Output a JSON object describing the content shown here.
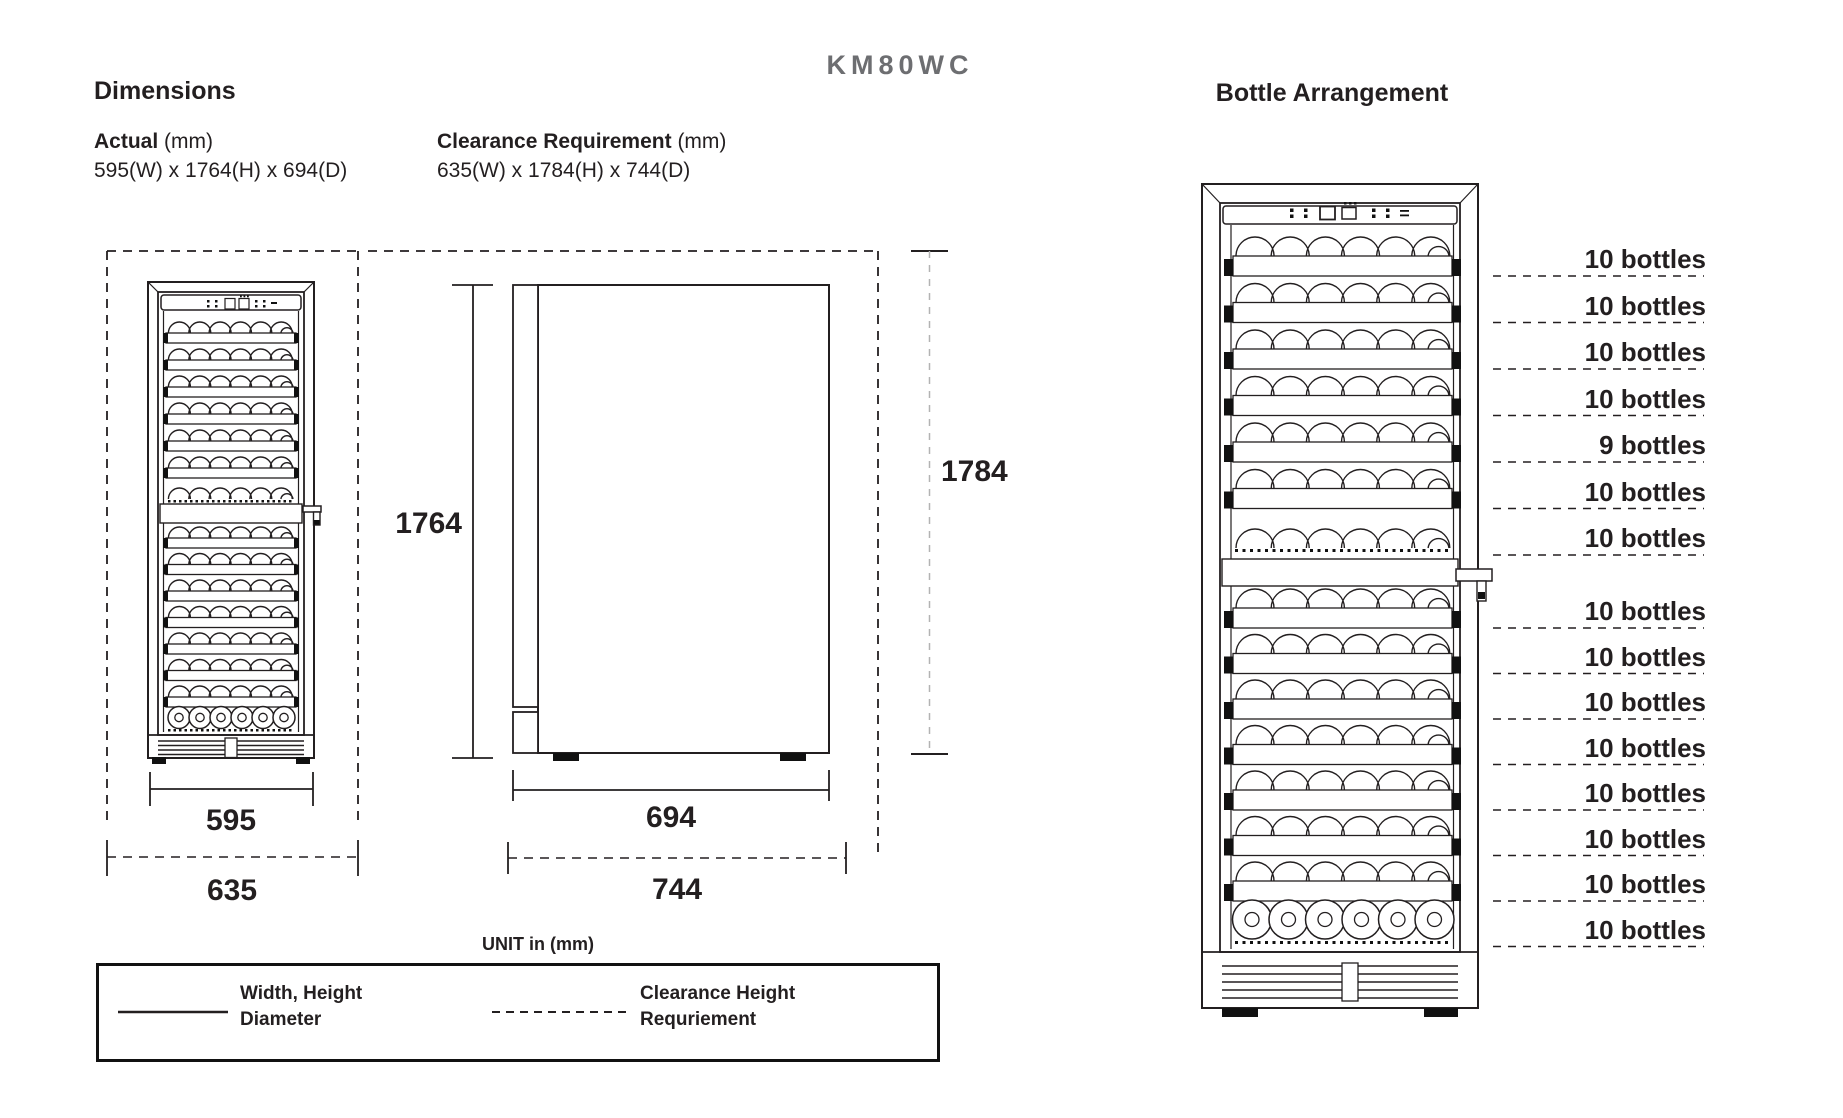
{
  "title": "KM80WC",
  "colors": {
    "ink": "#231f20",
    "title_gray": "#6d6e71",
    "light_dash": "#b3b3b3"
  },
  "dimensions": {
    "heading": "Dimensions",
    "actual": {
      "label": "Actual",
      "unit": "(mm)",
      "value": "595(W) x 1764(H) x 694(D)"
    },
    "clearance": {
      "label": "Clearance Requirement",
      "unit": "(mm)",
      "value": "635(W) x 1784(H) x 744(D)"
    },
    "front_view": {
      "width": "595",
      "clearance_width": "635"
    },
    "side_view": {
      "height": "1764",
      "depth": "694",
      "clearance_depth": "744",
      "clearance_height": "1784"
    },
    "unit_note": "UNIT in (mm)",
    "legend": {
      "solid": {
        "line1": "Width, Height",
        "line2": "Diameter"
      },
      "dashed": {
        "line1": "Clearance Height",
        "line2": "Requriement"
      }
    }
  },
  "bottle_arrangement": {
    "heading": "Bottle Arrangement",
    "upper_zone_labels": [
      "10 bottles",
      "10 bottles",
      "10 bottles",
      "10 bottles",
      "9 bottles",
      "10 bottles",
      "10 bottles"
    ],
    "lower_zone_labels": [
      "10 bottles",
      "10 bottles",
      "10 bottles",
      "10 bottles",
      "10 bottles",
      "10 bottles",
      "10 bottles",
      "10 bottles"
    ]
  }
}
